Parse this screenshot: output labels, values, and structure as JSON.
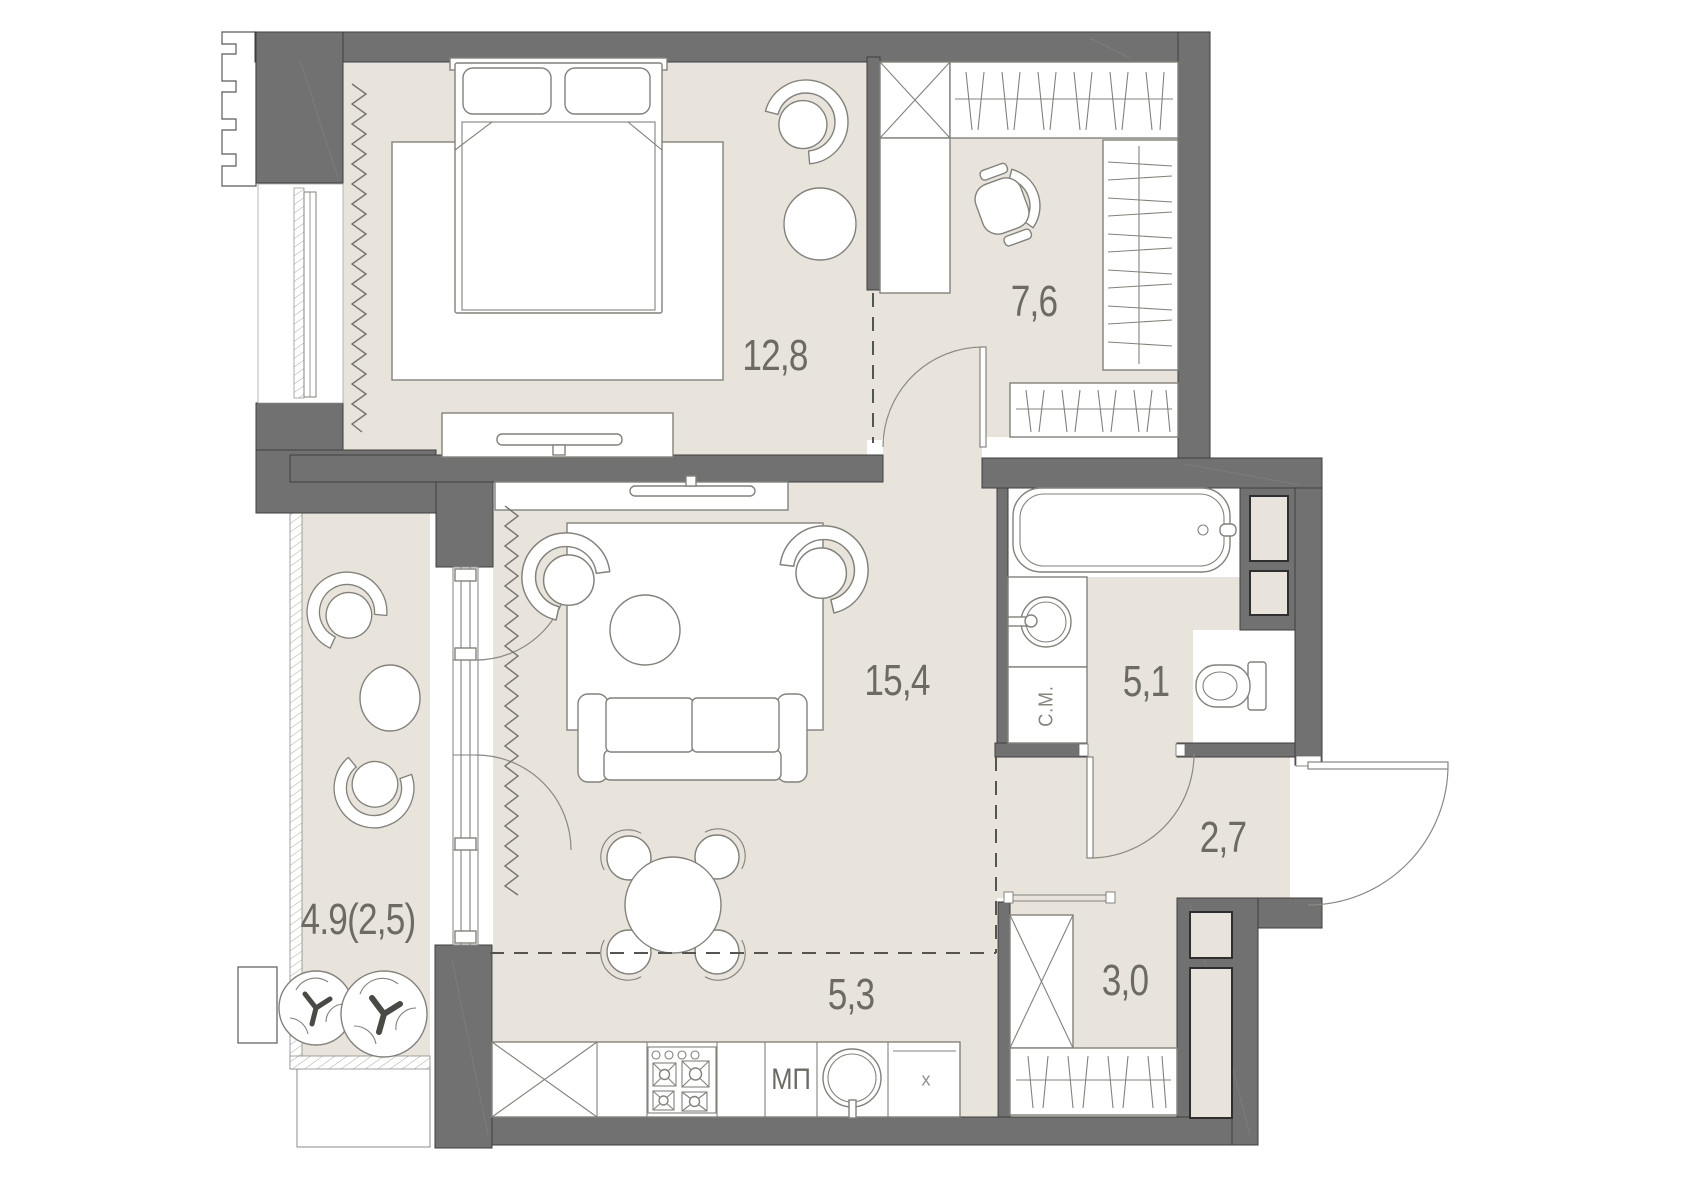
{
  "colors": {
    "wall": "#717171",
    "wall-outline": "#3e3e3e",
    "floor": "#e8e4dc",
    "line": "#82827b",
    "label": "#6b6b64",
    "dash": "#55554f",
    "bg": "#ffffff"
  },
  "floor_plan": {
    "type": "apartment-floor-plan",
    "room_labels": {
      "bedroom": "12,8",
      "dressing_room": "7,6",
      "living_room": "15,4",
      "bathroom": "5,1",
      "hallway": "2,7",
      "entry": "3,0",
      "kitchen": "5,3",
      "balcony": "4.9(2,5)"
    },
    "appliance_labels": {
      "washing_machine": "С.М.",
      "dishwasher": "МП",
      "cabinet": "х"
    }
  }
}
